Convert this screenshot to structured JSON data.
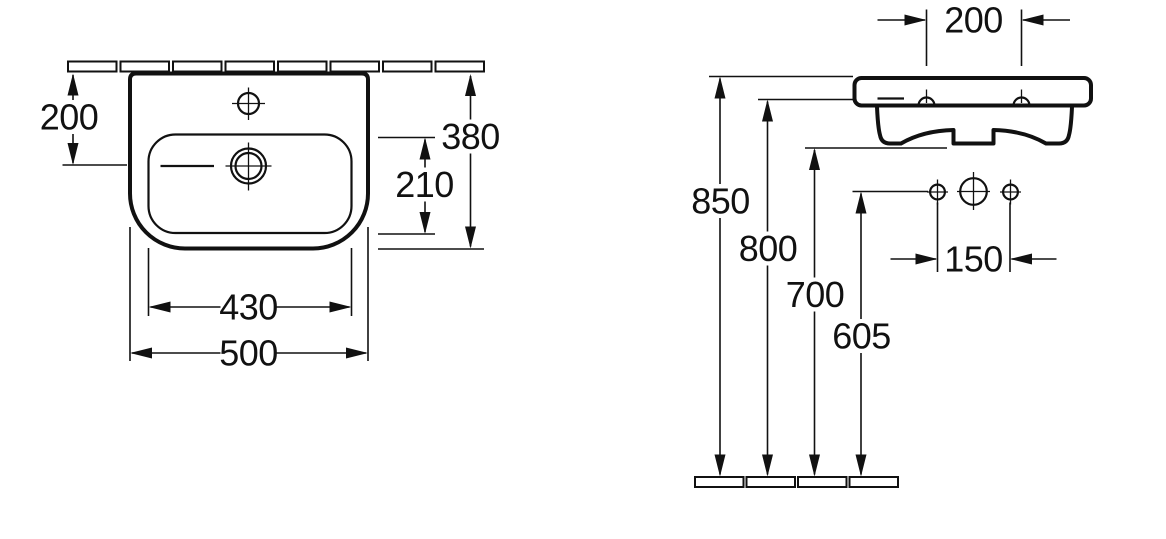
{
  "colors": {
    "line": "#111111",
    "background": "#ffffff"
  },
  "top_view": {
    "dim_wall_to_drain": "200",
    "dim_overall_depth": "380",
    "dim_bowl_depth": "210",
    "dim_bowl_width": "430",
    "dim_overall_width": "500"
  },
  "front_view": {
    "dim_fixing_hole_spacing": "200",
    "dim_rim_height": "850",
    "dim_fixing_height": "800",
    "dim_body_underside_height": "700",
    "dim_connection_height": "605",
    "dim_connection_spacing": "150"
  }
}
